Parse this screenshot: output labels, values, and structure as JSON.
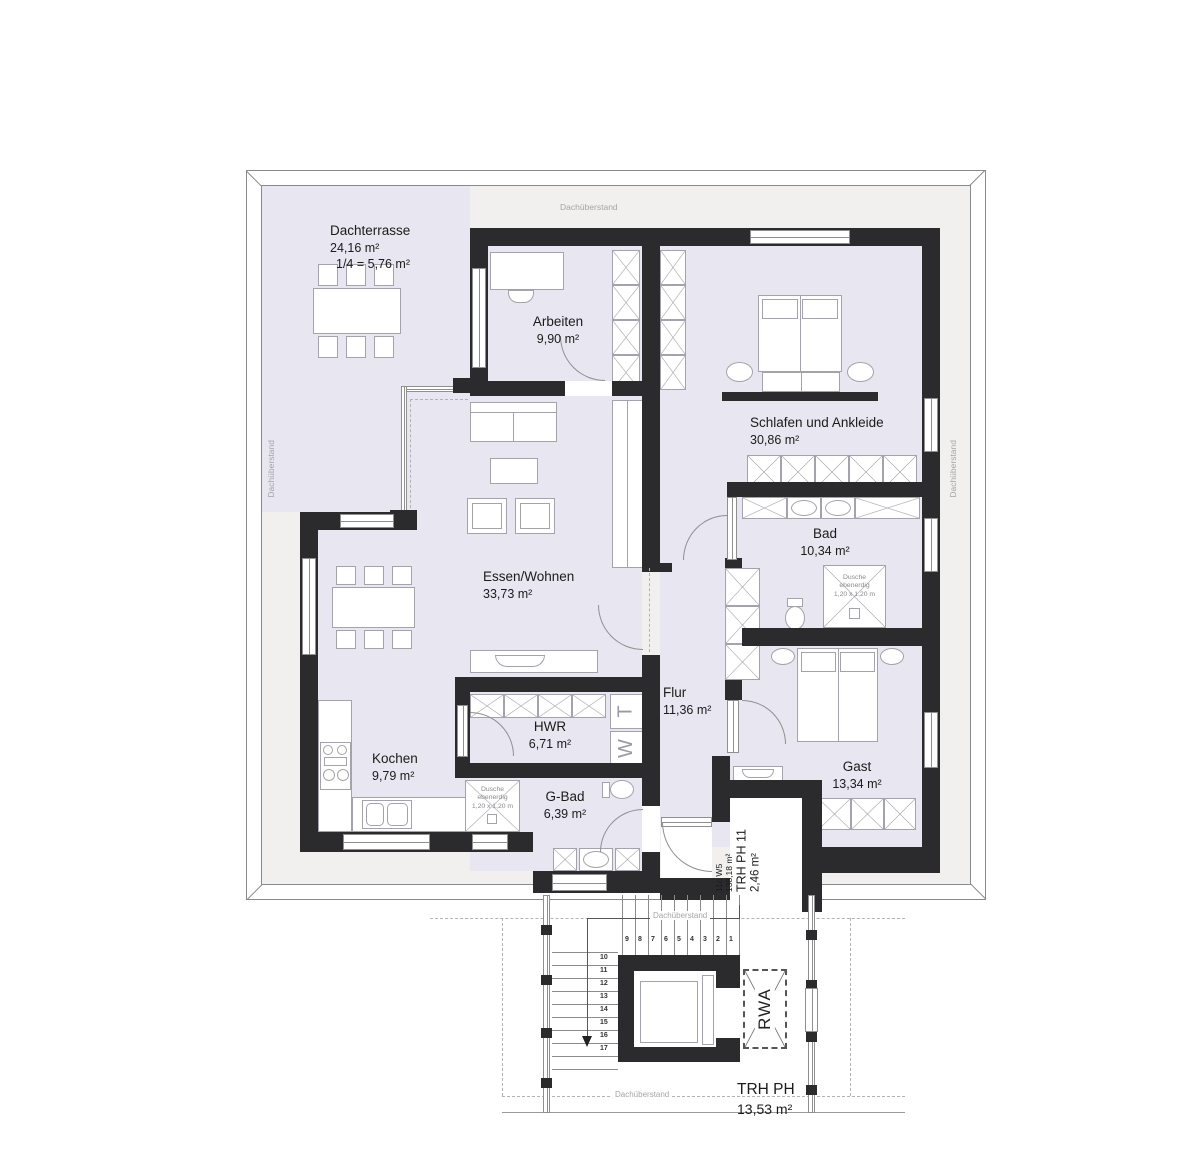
{
  "labels": {
    "overhang": "Dachüberstand"
  },
  "rooms": {
    "dachterrasse": {
      "name": "Dachterrasse",
      "area": "24,16 m²",
      "note": "1/4 = 5,76 m²"
    },
    "arbeiten": {
      "name": "Arbeiten",
      "area": "9,90 m²"
    },
    "schlafen": {
      "name": "Schlafen und Ankleide",
      "area": "30,86 m²"
    },
    "bad": {
      "name": "Bad",
      "area": "10,34 m²"
    },
    "essen": {
      "name": "Essen/Wohnen",
      "area": "33,73 m²"
    },
    "flur": {
      "name": "Flur",
      "area": "11,36 m²"
    },
    "hwr": {
      "name": "HWR",
      "area": "6,71 m²"
    },
    "kochen": {
      "name": "Kochen",
      "area": "9,79 m²"
    },
    "gbad": {
      "name": "G-Bad",
      "area": "6,39 m²"
    },
    "gast": {
      "name": "Gast",
      "area": "13,34 m²"
    }
  },
  "shower_note": {
    "line1": "Dusche",
    "line2": "ebenerdig",
    "line3": "1,20 x 1,20 m"
  },
  "unit_info": {
    "code": "11c W5",
    "area": "138,18 m²"
  },
  "stair_core": {
    "name": "TRH PH 11",
    "area": "2,46 m²"
  },
  "stairwell": {
    "name": "TRH PH",
    "area": "13,53 m²",
    "rwa": "RWA",
    "steps_upper": [
      "9",
      "8",
      "7",
      "6",
      "5",
      "4",
      "3",
      "2",
      "1"
    ],
    "steps_lower": [
      "10",
      "11",
      "12",
      "13",
      "14",
      "15",
      "16",
      "17"
    ]
  },
  "appliances": {
    "dryer": "T",
    "washer": "W"
  },
  "colors": {
    "wall": "#2b2b2d",
    "room": "#e8e6f0",
    "band": "#f1f0ee",
    "line": "#8a8a8a",
    "furn": "#a3a3ab"
  }
}
